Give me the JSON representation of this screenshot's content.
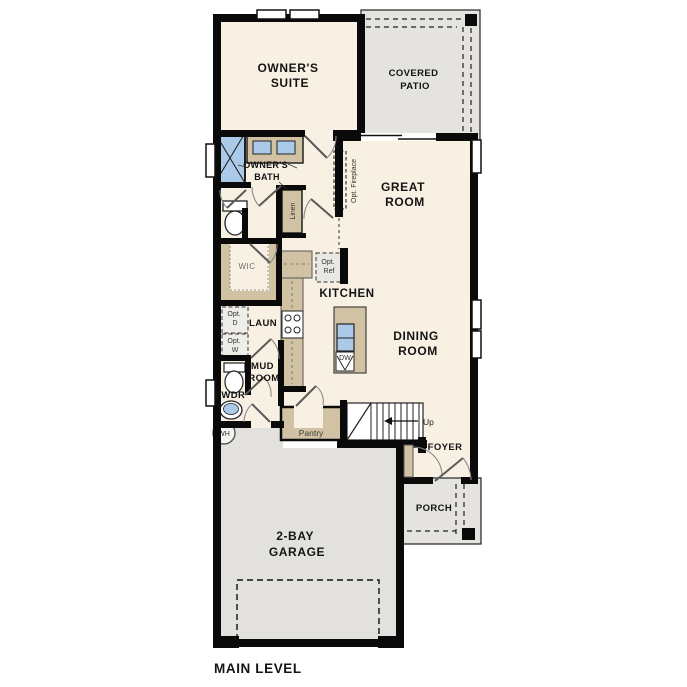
{
  "plan_title": "MAIN LEVEL",
  "colors": {
    "floor": "#f8f0e3",
    "outdoor": "#e4e3df",
    "wall": "#0a0a0a",
    "cabinet": "#d2c2a4",
    "fixture_blue": "#abc9e9"
  },
  "rooms": {
    "owners_suite": {
      "lines": [
        "OWNER'S",
        "SUITE"
      ]
    },
    "covered_patio": {
      "lines": [
        "COVERED",
        "PATIO"
      ]
    },
    "great_room": {
      "lines": [
        "GREAT",
        "ROOM"
      ]
    },
    "owners_bath": {
      "lines": [
        "OWNER'S",
        "BATH"
      ]
    },
    "wic": {
      "label": "WIC"
    },
    "linen": {
      "label": "Linen"
    },
    "kitchen": {
      "label": "KITCHEN"
    },
    "dining_room": {
      "lines": [
        "DINING",
        "ROOM"
      ]
    },
    "laundry": {
      "label": "LAUN"
    },
    "mud_room": {
      "lines": [
        "MUD",
        "ROOM"
      ]
    },
    "powder": {
      "label": "PWDR"
    },
    "pantry": {
      "label": "Pantry"
    },
    "foyer": {
      "label": "FOYER"
    },
    "porch": {
      "label": "PORCH"
    },
    "garage": {
      "lines": [
        "2-BAY",
        "GARAGE"
      ]
    }
  },
  "annotations": {
    "opt_fireplace": "Opt. Fireplace",
    "opt_ref": {
      "lines": [
        "Opt.",
        "Ref"
      ]
    },
    "opt_dryer": {
      "lines": [
        "Opt.",
        "D"
      ]
    },
    "opt_washer": {
      "lines": [
        "Opt.",
        "W"
      ]
    },
    "dishwasher": "DW",
    "water_heater": "WH",
    "stairs_up": "Up"
  }
}
